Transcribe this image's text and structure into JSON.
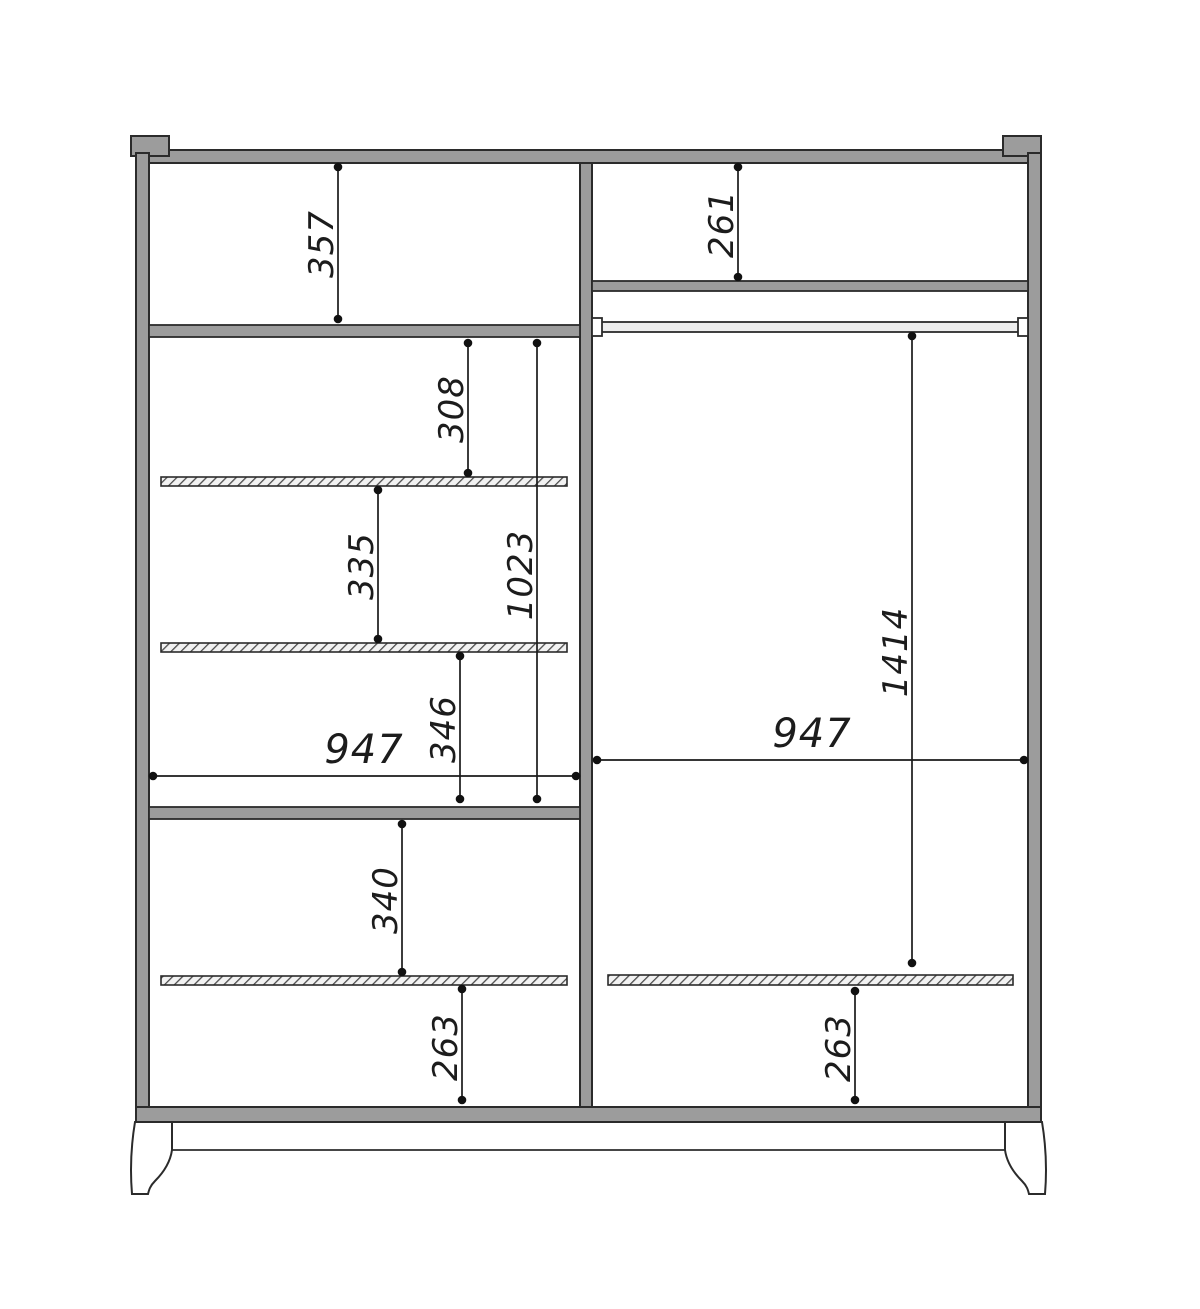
{
  "drawing": {
    "name": "wardrobe-internal-dimension-drawing",
    "unit": "mm",
    "colors": {
      "background": "#ffffff",
      "panel_fill": "#9c9c9c",
      "outline": "#2b2b2b",
      "dimension": "#1a1a1a"
    },
    "dims": {
      "left_top_height": "357",
      "left_gap_shelf1": "308",
      "left_shelf_zone_height": "1023",
      "left_gap_shelf2": "335",
      "left_gap_shelf3": "346",
      "left_width": "947",
      "left_gap_lower": "340",
      "left_gap_bottom": "263",
      "right_top_height": "261",
      "right_rod_drop": "1414",
      "right_width": "947",
      "right_gap_bottom": "263"
    }
  }
}
